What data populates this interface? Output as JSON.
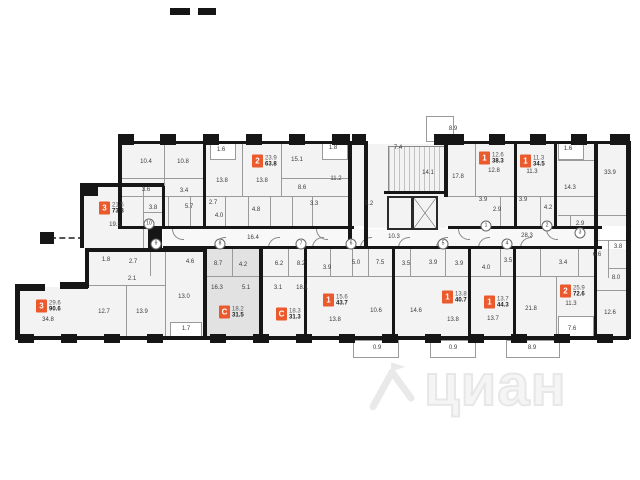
{
  "plan": {
    "accent_color": "#eb5a2d",
    "highlight_color": "#e2e2e2",
    "wall_color": "#161616"
  },
  "watermark": {
    "text": "циан"
  },
  "units": [
    {
      "rooms": "3",
      "area_top": "21.5",
      "area_total": "73.8",
      "x": 99,
      "y": 208,
      "highlighted": false
    },
    {
      "rooms": "2",
      "area_top": "23.9",
      "area_total": "63.8",
      "x": 252,
      "y": 161,
      "highlighted": false
    },
    {
      "rooms": "1",
      "area_top": "12.6",
      "area_total": "38.3",
      "x": 479,
      "y": 158,
      "highlighted": false
    },
    {
      "rooms": "1",
      "area_top": "11.3",
      "area_total": "34.5",
      "x": 520,
      "y": 161,
      "highlighted": false
    },
    {
      "rooms": "3",
      "area_top": "29.6",
      "area_total": "90.6",
      "x": 36,
      "y": 306,
      "highlighted": false
    },
    {
      "rooms": "С",
      "area_top": "18.2",
      "area_total": "31.5",
      "x": 219,
      "y": 312,
      "highlighted": true
    },
    {
      "rooms": "С",
      "area_top": "18.3",
      "area_total": "31.3",
      "x": 276,
      "y": 314,
      "highlighted": false
    },
    {
      "rooms": "1",
      "area_top": "15.6",
      "area_total": "43.7",
      "x": 323,
      "y": 300,
      "highlighted": false
    },
    {
      "rooms": "1",
      "area_top": "13.8",
      "area_total": "40.7",
      "x": 442,
      "y": 297,
      "highlighted": false
    },
    {
      "rooms": "1",
      "area_top": "13.7",
      "area_total": "44.3",
      "x": 484,
      "y": 302,
      "highlighted": false
    },
    {
      "rooms": "2",
      "area_top": "25.9",
      "area_total": "72.6",
      "x": 560,
      "y": 291,
      "highlighted": false
    }
  ],
  "room_labels": [
    {
      "t": "10.4",
      "x": 146,
      "y": 162
    },
    {
      "t": "10.8",
      "x": 183,
      "y": 162
    },
    {
      "t": "3.6",
      "x": 146,
      "y": 190
    },
    {
      "t": "3.4",
      "x": 184,
      "y": 191
    },
    {
      "t": "3.8",
      "x": 153,
      "y": 208
    },
    {
      "t": "5.7",
      "x": 189,
      "y": 207
    },
    {
      "t": "2.7",
      "x": 213,
      "y": 203
    },
    {
      "t": "4.0",
      "x": 219,
      "y": 216
    },
    {
      "t": "1.6",
      "x": 221,
      "y": 150
    },
    {
      "t": "13.8",
      "x": 222,
      "y": 181
    },
    {
      "t": "13.8",
      "x": 262,
      "y": 181
    },
    {
      "t": "4.8",
      "x": 256,
      "y": 210
    },
    {
      "t": "15.1",
      "x": 297,
      "y": 160
    },
    {
      "t": "8.6",
      "x": 302,
      "y": 188
    },
    {
      "t": "3.3",
      "x": 314,
      "y": 204
    },
    {
      "t": "1.8",
      "x": 333,
      "y": 148
    },
    {
      "t": "11.2",
      "x": 336,
      "y": 179
    },
    {
      "t": "19.5",
      "x": 115,
      "y": 225
    },
    {
      "t": "7.4",
      "x": 398,
      "y": 148
    },
    {
      "t": "14.1",
      "x": 428,
      "y": 173
    },
    {
      "t": "5.2",
      "x": 369,
      "y": 204
    },
    {
      "t": "10.3",
      "x": 394,
      "y": 237
    },
    {
      "t": "8.9",
      "x": 453,
      "y": 129
    },
    {
      "t": "17.8",
      "x": 458,
      "y": 177
    },
    {
      "t": "12.8",
      "x": 494,
      "y": 171
    },
    {
      "t": "3.9",
      "x": 483,
      "y": 200
    },
    {
      "t": "2.9",
      "x": 497,
      "y": 210
    },
    {
      "t": "11.3",
      "x": 532,
      "y": 172
    },
    {
      "t": "3.9",
      "x": 523,
      "y": 200
    },
    {
      "t": "4.2",
      "x": 548,
      "y": 208
    },
    {
      "t": "1.6",
      "x": 568,
      "y": 149
    },
    {
      "t": "14.3",
      "x": 570,
      "y": 188
    },
    {
      "t": "33.9",
      "x": 610,
      "y": 173
    },
    {
      "t": "2.9",
      "x": 580,
      "y": 224
    },
    {
      "t": "16.4",
      "x": 253,
      "y": 238
    },
    {
      "t": "28.3",
      "x": 527,
      "y": 236
    },
    {
      "t": "1.8",
      "x": 106,
      "y": 260
    },
    {
      "t": "2.7",
      "x": 133,
      "y": 262
    },
    {
      "t": "2.1",
      "x": 132,
      "y": 279
    },
    {
      "t": "4.6",
      "x": 190,
      "y": 262
    },
    {
      "t": "13.0",
      "x": 184,
      "y": 297
    },
    {
      "t": "34.8",
      "x": 48,
      "y": 320
    },
    {
      "t": "12.7",
      "x": 104,
      "y": 312
    },
    {
      "t": "13.9",
      "x": 142,
      "y": 312
    },
    {
      "t": "1.7",
      "x": 186,
      "y": 329
    },
    {
      "t": "8.7",
      "x": 218,
      "y": 264
    },
    {
      "t": "16.3",
      "x": 217,
      "y": 288
    },
    {
      "t": "4.2",
      "x": 243,
      "y": 265
    },
    {
      "t": "5.1",
      "x": 246,
      "y": 288
    },
    {
      "t": "6.2",
      "x": 279,
      "y": 264
    },
    {
      "t": "3.1",
      "x": 278,
      "y": 288
    },
    {
      "t": "8.2",
      "x": 301,
      "y": 264
    },
    {
      "t": "18.1",
      "x": 302,
      "y": 288
    },
    {
      "t": "3.9",
      "x": 327,
      "y": 268
    },
    {
      "t": "13.8",
      "x": 335,
      "y": 320
    },
    {
      "t": "5.0",
      "x": 356,
      "y": 263
    },
    {
      "t": "7.5",
      "x": 380,
      "y": 263
    },
    {
      "t": "10.6",
      "x": 376,
      "y": 311
    },
    {
      "t": "3.5",
      "x": 406,
      "y": 264
    },
    {
      "t": "14.6",
      "x": 416,
      "y": 311
    },
    {
      "t": "3.9",
      "x": 433,
      "y": 263
    },
    {
      "t": "3.9",
      "x": 459,
      "y": 264
    },
    {
      "t": "13.8",
      "x": 453,
      "y": 320
    },
    {
      "t": "4.0",
      "x": 486,
      "y": 268
    },
    {
      "t": "3.5",
      "x": 508,
      "y": 261
    },
    {
      "t": "13.7",
      "x": 493,
      "y": 319
    },
    {
      "t": "21.8",
      "x": 531,
      "y": 309
    },
    {
      "t": "3.4",
      "x": 563,
      "y": 263
    },
    {
      "t": "11.3",
      "x": 571,
      "y": 304
    },
    {
      "t": "7.6",
      "x": 572,
      "y": 329
    },
    {
      "t": "6.6",
      "x": 597,
      "y": 255
    },
    {
      "t": "3.8",
      "x": 618,
      "y": 247
    },
    {
      "t": "8.0",
      "x": 616,
      "y": 278
    },
    {
      "t": "12.6",
      "x": 610,
      "y": 313
    },
    {
      "t": "0.9",
      "x": 377,
      "y": 348
    },
    {
      "t": "0.9",
      "x": 453,
      "y": 348
    },
    {
      "t": "8.9",
      "x": 532,
      "y": 348
    }
  ],
  "grid_markers": [
    {
      "t": "1",
      "x": 486,
      "y": 226
    },
    {
      "t": "2",
      "x": 547,
      "y": 226
    },
    {
      "t": "3",
      "x": 580,
      "y": 233
    },
    {
      "t": "4",
      "x": 507,
      "y": 244
    },
    {
      "t": "5",
      "x": 443,
      "y": 244
    },
    {
      "t": "6",
      "x": 351,
      "y": 244
    },
    {
      "t": "7",
      "x": 301,
      "y": 244
    },
    {
      "t": "8",
      "x": 220,
      "y": 244
    },
    {
      "t": "9",
      "x": 156,
      "y": 244
    },
    {
      "t": "10",
      "x": 149,
      "y": 224
    }
  ]
}
